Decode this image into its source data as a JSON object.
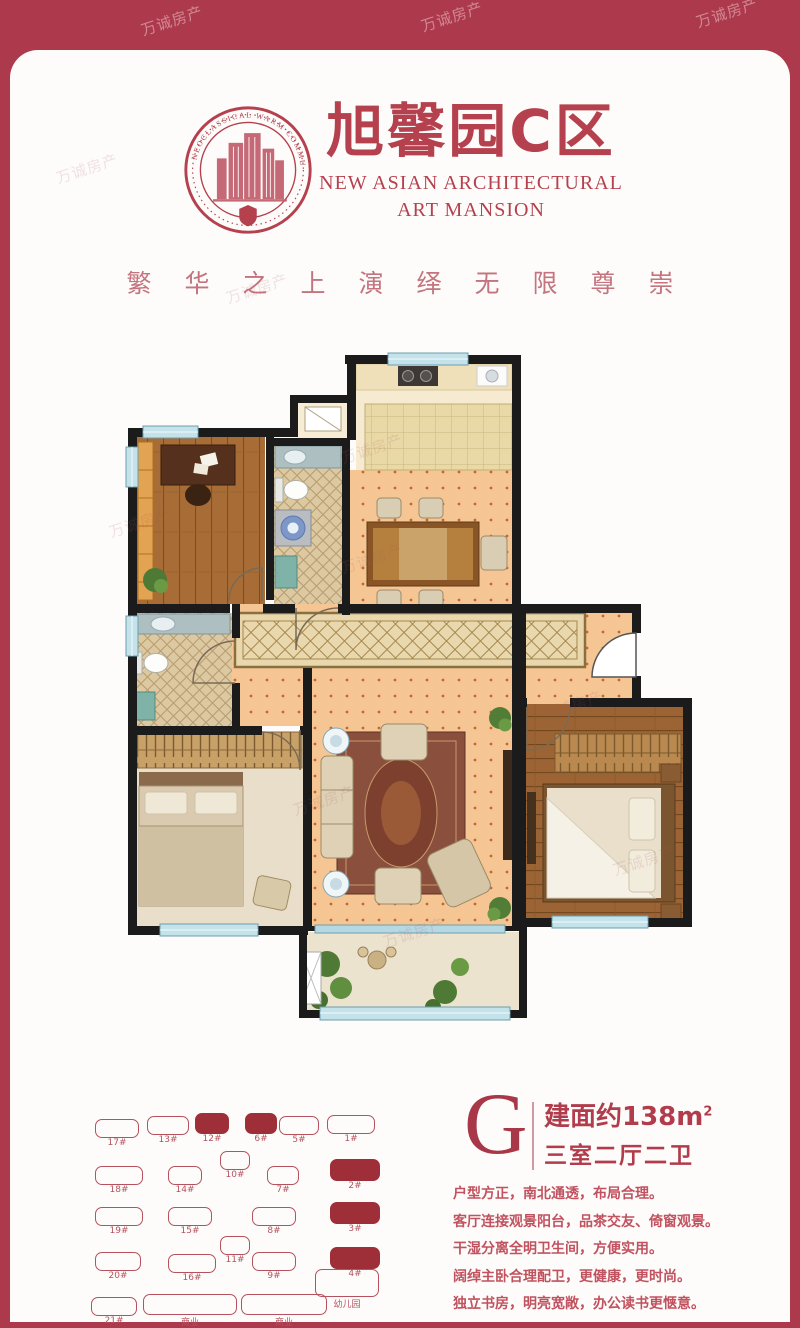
{
  "watermark": {
    "text": "万诚房产"
  },
  "header": {
    "emblem_ring_text": "NEOCLASSICAL WARM COMMUNITY",
    "title": "旭馨园C区",
    "subtitle_line1": "NEW ASIAN ARCHITECTURAL",
    "subtitle_line2": "ART MANSION",
    "slogan": "繁华之上演绎无限尊崇"
  },
  "unit_info": {
    "type_letter": "G",
    "area_text": "建面约138m",
    "area_sup": "2",
    "layout": "三室二厅二卫"
  },
  "features": [
    "户型方正，南北通透，布局合理。",
    "客厅连接观景阳台，品茶交友、倚窗观景。",
    "干湿分离全明卫生间，方便实用。",
    "阔绰主卧合理配卫，更健康，更时尚。",
    "独立书房，明亮宽敞，办公读书更惬意。"
  ],
  "site_plan": {
    "buildings": [
      {
        "label": "17#",
        "filled": false,
        "x": 20,
        "y": 16,
        "w": 42,
        "h": 17
      },
      {
        "label": "13#",
        "filled": false,
        "x": 72,
        "y": 13,
        "w": 40,
        "h": 17
      },
      {
        "label": "12#",
        "filled": true,
        "x": 120,
        "y": 10,
        "w": 32,
        "h": 19
      },
      {
        "label": "6#",
        "filled": true,
        "x": 170,
        "y": 10,
        "w": 30,
        "h": 19
      },
      {
        "label": "5#",
        "filled": false,
        "x": 204,
        "y": 13,
        "w": 38,
        "h": 17
      },
      {
        "label": "1#",
        "filled": false,
        "x": 252,
        "y": 12,
        "w": 46,
        "h": 17
      },
      {
        "label": "18#",
        "filled": false,
        "x": 20,
        "y": 63,
        "w": 46,
        "h": 17
      },
      {
        "label": "14#",
        "filled": false,
        "x": 93,
        "y": 63,
        "w": 32,
        "h": 17
      },
      {
        "label": "10#",
        "filled": false,
        "x": 145,
        "y": 48,
        "w": 28,
        "h": 17
      },
      {
        "label": "7#",
        "filled": false,
        "x": 192,
        "y": 63,
        "w": 30,
        "h": 17
      },
      {
        "label": "2#",
        "filled": true,
        "x": 255,
        "y": 56,
        "w": 48,
        "h": 20
      },
      {
        "label": "19#",
        "filled": false,
        "x": 20,
        "y": 104,
        "w": 46,
        "h": 17
      },
      {
        "label": "15#",
        "filled": false,
        "x": 93,
        "y": 104,
        "w": 42,
        "h": 17
      },
      {
        "label": "8#",
        "filled": false,
        "x": 177,
        "y": 104,
        "w": 42,
        "h": 17
      },
      {
        "label": "3#",
        "filled": true,
        "x": 255,
        "y": 99,
        "w": 48,
        "h": 20
      },
      {
        "label": "11#",
        "filled": false,
        "x": 145,
        "y": 133,
        "w": 28,
        "h": 17
      },
      {
        "label": "20#",
        "filled": false,
        "x": 20,
        "y": 149,
        "w": 44,
        "h": 17
      },
      {
        "label": "16#",
        "filled": false,
        "x": 93,
        "y": 151,
        "w": 46,
        "h": 17
      },
      {
        "label": "9#",
        "filled": false,
        "x": 177,
        "y": 149,
        "w": 42,
        "h": 17
      },
      {
        "label": "4#",
        "filled": true,
        "x": 255,
        "y": 144,
        "w": 48,
        "h": 20
      },
      {
        "label": "21#",
        "filled": false,
        "x": 16,
        "y": 194,
        "w": 44,
        "h": 17
      },
      {
        "label": "商业",
        "filled": false,
        "x": 68,
        "y": 191,
        "w": 92,
        "h": 19
      },
      {
        "label": "商业",
        "filled": false,
        "x": 166,
        "y": 191,
        "w": 84,
        "h": 19
      },
      {
        "label": "幼儿园",
        "filled": false,
        "x": 240,
        "y": 166,
        "w": 62,
        "h": 26
      }
    ]
  }
}
